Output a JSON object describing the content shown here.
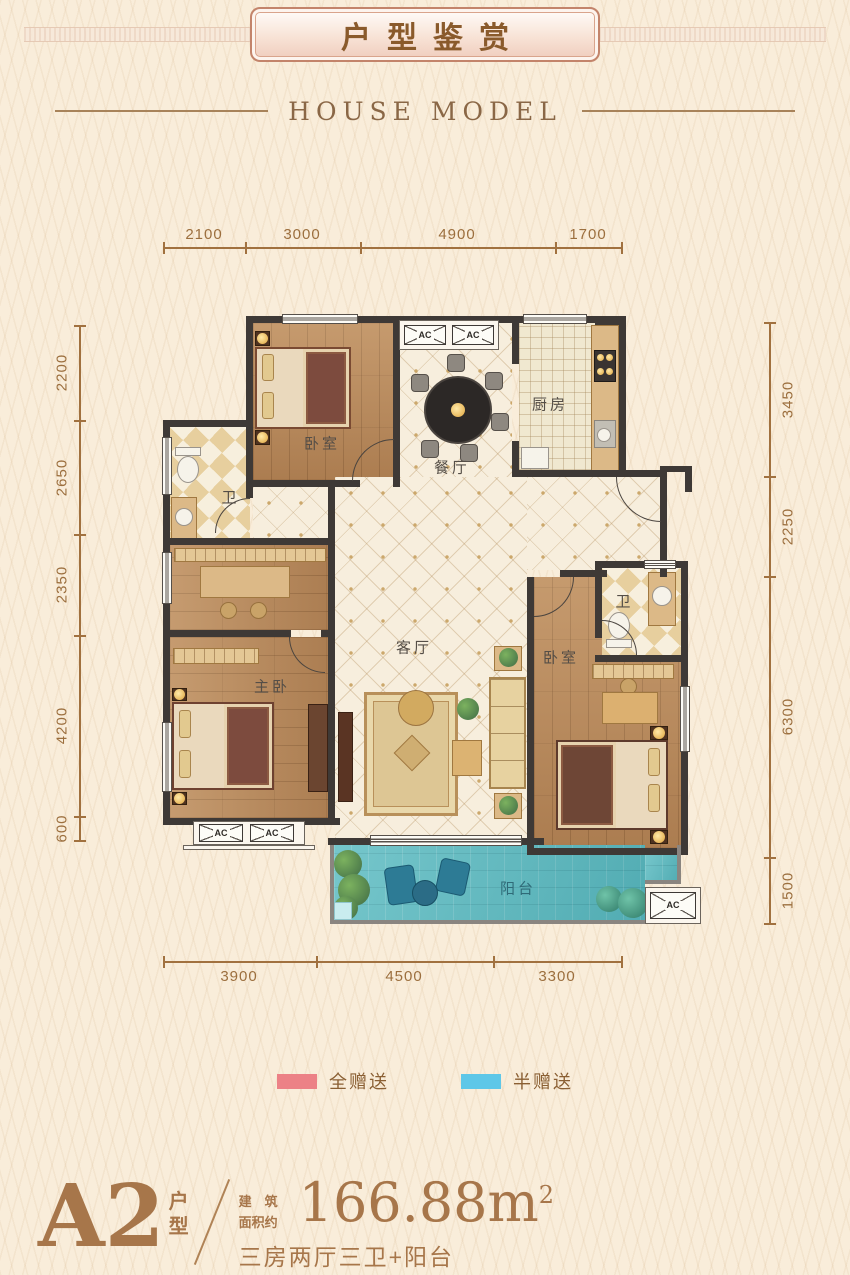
{
  "header": {
    "title": "户型鉴赏",
    "subtitle": "HOUSE MODEL"
  },
  "dims": {
    "top": [
      "2100",
      "3000",
      "4900",
      "1700"
    ],
    "bottom": [
      "3900",
      "4500",
      "3300"
    ],
    "left": [
      "2200",
      "2650",
      "2350",
      "4200",
      "600"
    ],
    "right": [
      "3450",
      "2250",
      "6300",
      "1500"
    ]
  },
  "rooms": {
    "bedroom_top": "卧室",
    "dining": "餐厅",
    "kitchen": "厨房",
    "bath_left": "卫",
    "living": "客厅",
    "master": "主卧",
    "bedroom_right": "卧室",
    "bath_right": "卫",
    "balcony": "阳台"
  },
  "ac_label": "AC",
  "legend": {
    "full_gift": {
      "label": "全赠送",
      "color": "#ec8186"
    },
    "half_gift": {
      "label": "半赠送",
      "color": "#5ec7e8"
    }
  },
  "footer": {
    "plan_code": "A2",
    "plan_type_1": "户",
    "plan_type_2": "型",
    "area_label_1": "建筑",
    "area_label_2": "面积约",
    "area_value": "166.88m",
    "area_sup": "2",
    "layout_desc": "三房两厅三卫+阳台"
  },
  "colors": {
    "background": "#f9edda",
    "wall": "#3e3936",
    "wood": "#b9895a",
    "tile": "#f7eedd",
    "balcony": "#5fbdc3",
    "dimension": "#9c6f3e",
    "accent_text": "#a7764a",
    "title_text": "#8a5a2b"
  }
}
